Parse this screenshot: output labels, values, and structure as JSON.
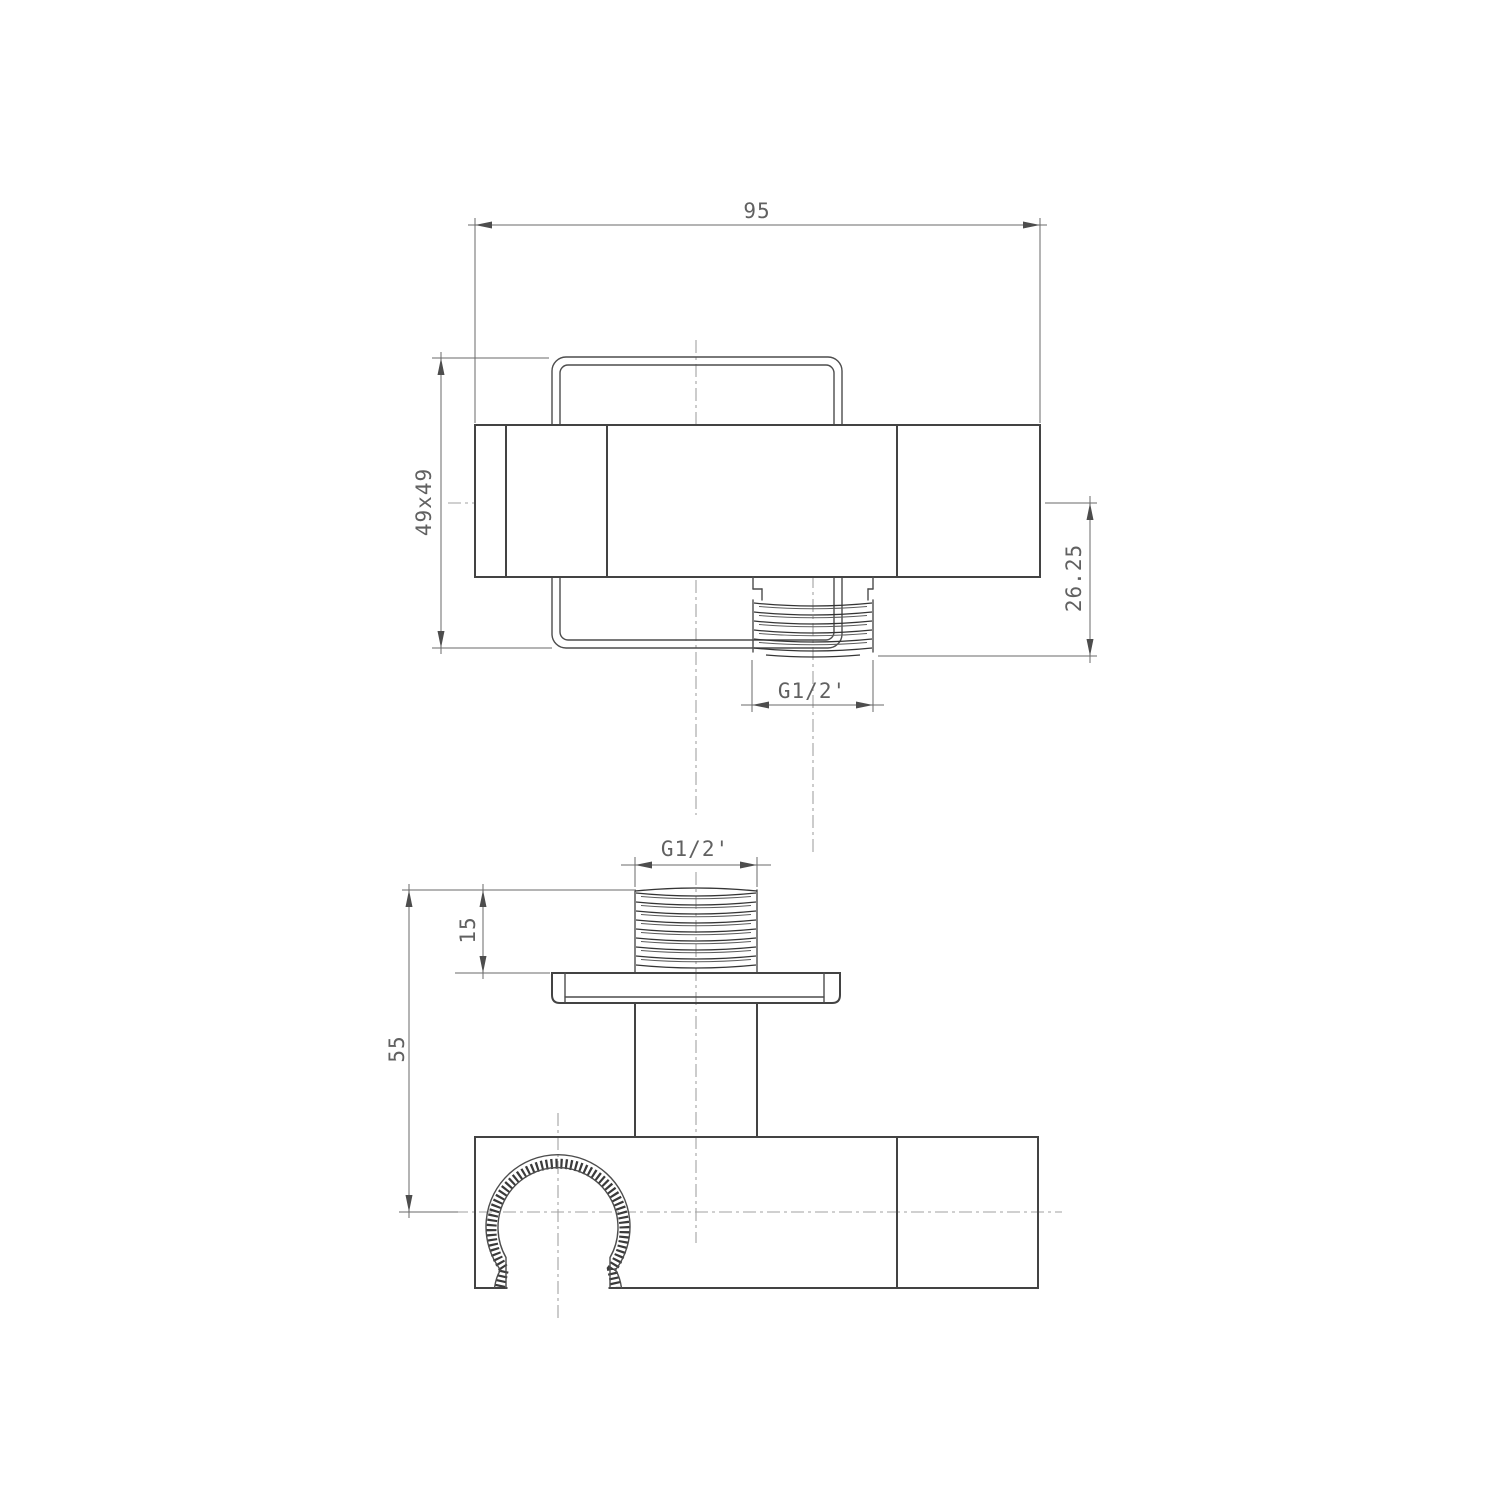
{
  "drawing": {
    "type": "technical-drawing",
    "subject": "wall shower bracket with outlet elbow",
    "views": {
      "top_view": {
        "dims": {
          "overall_width": "95",
          "section_square": "49x49",
          "outlet_offset": "26.25",
          "outlet_thread": "G1/2'"
        }
      },
      "front_view": {
        "dims": {
          "inlet_thread": "G1/2'",
          "thread_length": "15",
          "overall_height": "55"
        }
      }
    },
    "colors": {
      "background": "#ffffff",
      "outline": "#434343",
      "dimension": "#6a6a6a",
      "centerline": "#a2a2a2",
      "text": "#616161"
    }
  }
}
